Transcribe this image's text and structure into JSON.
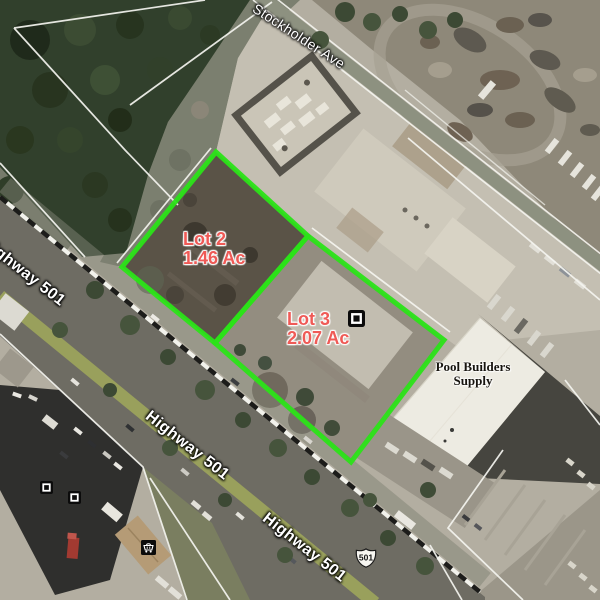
{
  "map": {
    "streets": {
      "stockholder": "Stockholder Ave",
      "highway_left": "Highway 501",
      "highway_mid": "Highway 501",
      "highway_bottom": "Highway 501"
    },
    "shield": {
      "route": "501"
    },
    "lots": [
      {
        "name": "Lot 2",
        "area": "1.46 Ac"
      },
      {
        "name": "Lot 3",
        "area": "2.07 Ac"
      }
    ],
    "business": {
      "line1": "Pool Builders",
      "line2": "Supply"
    },
    "markers": [
      {
        "type": "parcel-box-marker"
      },
      {
        "type": "parcel-box-marker"
      },
      {
        "type": "parcel-box-marker"
      },
      {
        "type": "store-basket-marker"
      }
    ],
    "colors": {
      "lot_outline": "#2be318",
      "lot_label": "#ef5a56",
      "street_label": "#ffffff",
      "business_label": "#17140f",
      "shield_fill": "#f7f6f1",
      "shield_text": "#111111"
    }
  }
}
